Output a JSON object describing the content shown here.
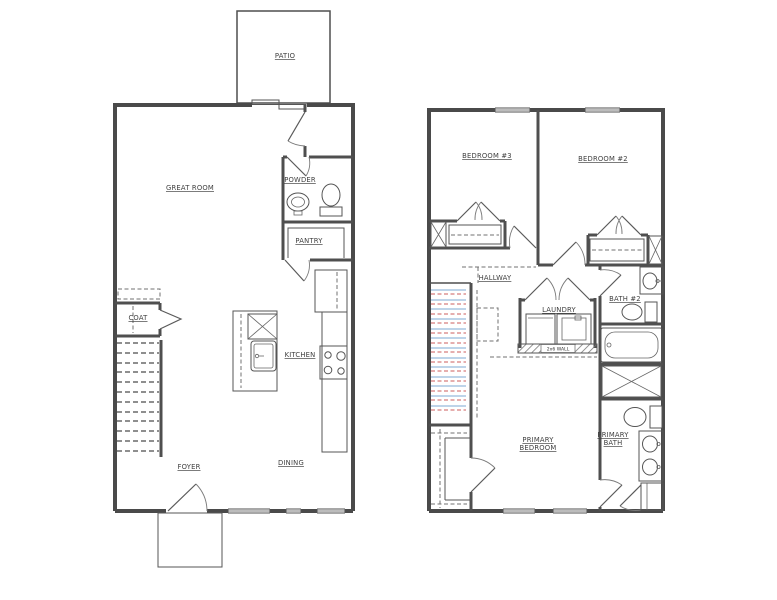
{
  "drawing": {
    "type": "residential floor plan, two levels",
    "colors": {
      "background": "#ffffff",
      "wall_line": "#4a4a4a",
      "stair_tread_blue": "#a9c6e2",
      "stair_tread_red": "#dd9494"
    },
    "first_floor": {
      "rooms": {
        "patio": "PATIO",
        "great_room": "GREAT ROOM",
        "powder": "POWDER",
        "pantry": "PANTRY",
        "kitchen": "KITCHEN",
        "coat": "COAT",
        "foyer": "FOYER",
        "dining": "DINING"
      }
    },
    "second_floor": {
      "rooms": {
        "bedroom3": "BEDROOM #3",
        "bedroom2": "BEDROOM #2",
        "hallway": "HALLWAY",
        "laundry": "LAUNDRY",
        "bath2": "BATH #2",
        "wall_note": "2x6 WALL",
        "primary_bedroom": [
          "PRIMARY",
          "BEDROOM"
        ],
        "primary_bath": [
          "PRIMARY",
          "BATH"
        ]
      }
    }
  }
}
